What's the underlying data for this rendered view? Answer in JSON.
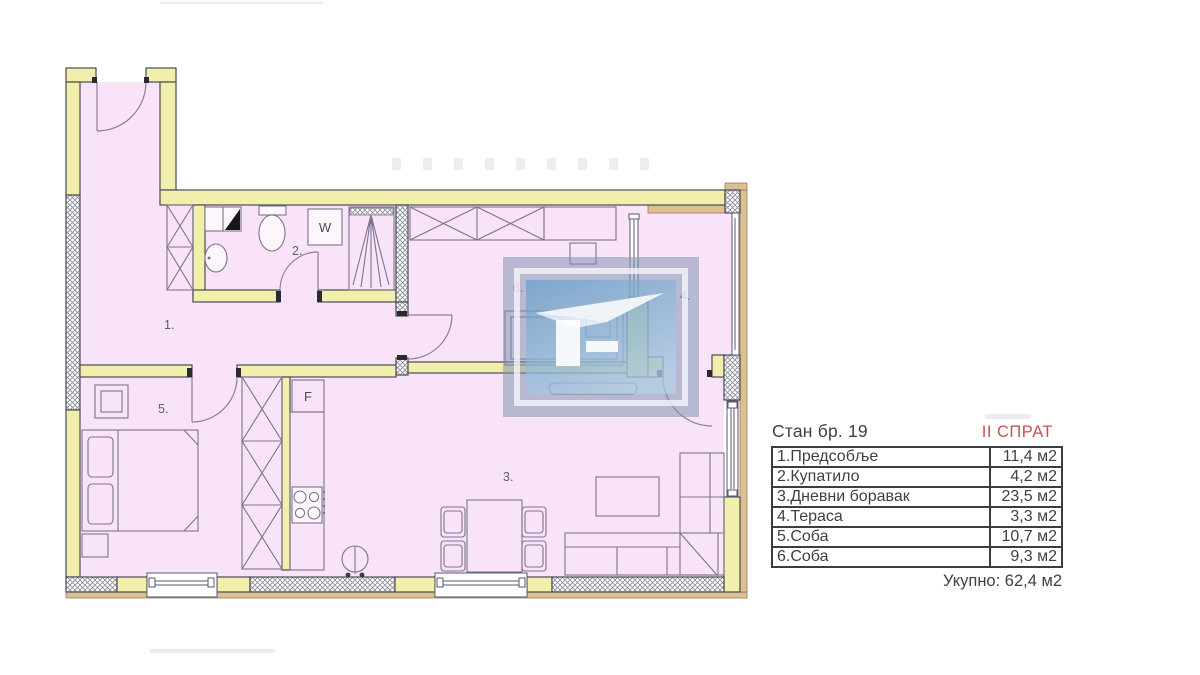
{
  "plan": {
    "labels": {
      "hallway": "1.",
      "bathroom": "2.",
      "living_room": "3.",
      "terrace": "4.",
      "bedroom": "5.",
      "room": "6.",
      "washing_machine": "W",
      "fridge": "F"
    }
  },
  "legend": {
    "title": "Стан бр. 19",
    "floor": "II СПРАТ",
    "rows": [
      {
        "label": "1.Предсобље",
        "value": "11,4 м2"
      },
      {
        "label": "2.Купатило",
        "value": "4,2 м2"
      },
      {
        "label": "3.Дневни боравак",
        "value": "23,5 м2"
      },
      {
        "label": "4.Тераса",
        "value": "3,3 м2"
      },
      {
        "label": "5.Соба",
        "value": "10,7 м2"
      },
      {
        "label": "6.Соба",
        "value": "9,3 м2"
      }
    ],
    "total": "Укупно: 62,4 м2"
  },
  "colors": {
    "floor_fill": "#f9e3f8",
    "wall_fill": "#f1efab",
    "facade_tan": "#dcc092",
    "accent_red": "#c4534f",
    "watermark_outer_blue": "#7e90b0",
    "watermark_panel_blue": "#5e9cc8"
  }
}
